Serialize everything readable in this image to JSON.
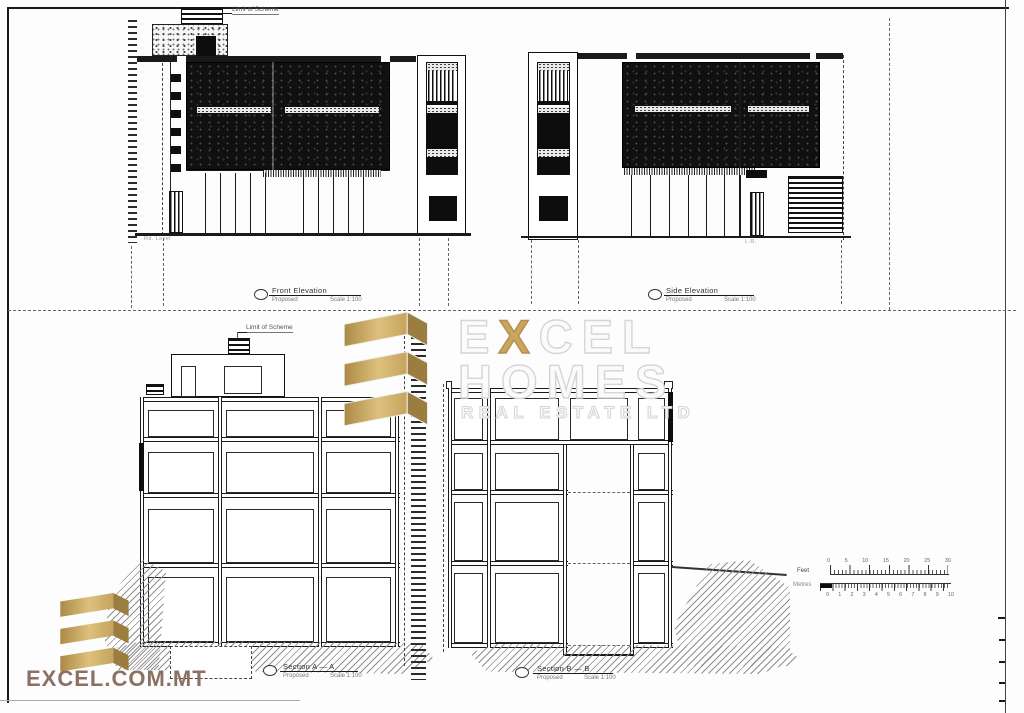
{
  "sheet": {
    "background": "#fdfdfd",
    "ink": "#1a1a1a"
  },
  "annotations": {
    "limit_of_scheme_top": "Limit of Scheme",
    "limit_of_scheme_section": "Limit of Scheme",
    "road_level": "Rd. Level",
    "lr": "L.R."
  },
  "titles": {
    "front": {
      "title": "Front Elevation",
      "status": "Proposed",
      "scale": "Scale 1:100"
    },
    "side": {
      "title": "Side Elevation",
      "status": "Proposed",
      "scale": "Scale 1:100"
    },
    "section_a": {
      "title": "Section A — A",
      "status": "Proposed",
      "scale": "Scale 1:100"
    },
    "section_b": {
      "title": "Section B — B",
      "status": "Proposed",
      "scale": "Scale 1:100"
    }
  },
  "scale_bar": {
    "feet_label": "Feet",
    "metres_label": "Metres",
    "feet_ticks": [
      "0",
      "5",
      "10",
      "15",
      "20",
      "25",
      "30"
    ],
    "metre_ticks": [
      "0",
      "1",
      "2",
      "3",
      "4",
      "5",
      "6",
      "7",
      "8",
      "9",
      "10"
    ]
  },
  "watermark": {
    "line1_pre": "E",
    "line1_x": "X",
    "line1_post": "CEL",
    "line2": "HOMES",
    "line3": "REAL ESTATE LTD",
    "gold": "#c9a55f"
  },
  "footer": {
    "logo_text": "EXCEL.COM.MT",
    "color": "#8a7164"
  }
}
